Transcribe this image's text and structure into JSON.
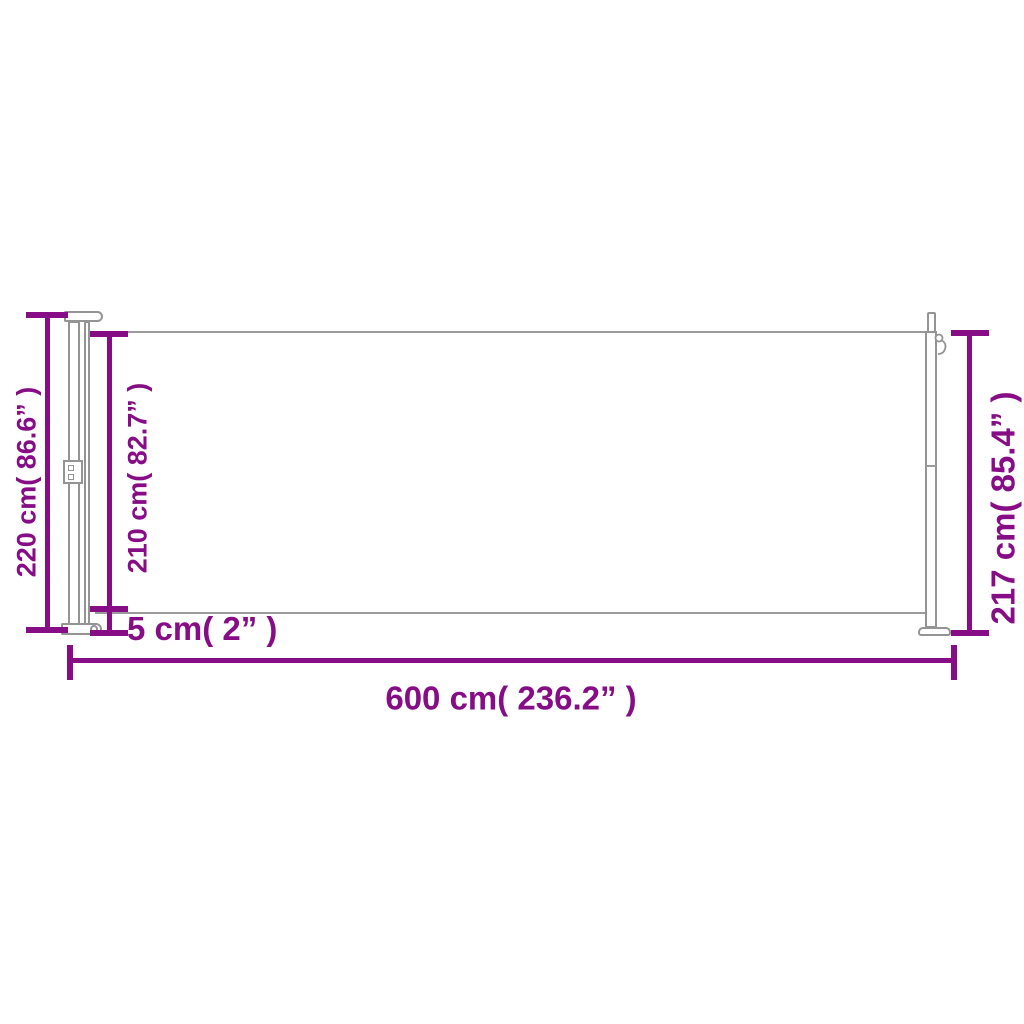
{
  "diagram": {
    "type": "product-dimension-diagram",
    "accent_color": "#860d86",
    "outline_color": "#949494",
    "background": "#ffffff",
    "dimensions": {
      "total_height": {
        "label": "220 cm( 86.6” )",
        "cm": 220,
        "inches": 86.6,
        "side": "left-outer"
      },
      "fabric_height": {
        "label": "210 cm( 82.7” )",
        "cm": 210,
        "inches": 82.7,
        "side": "left-inner"
      },
      "ground_clearance": {
        "label": "5 cm( 2” )",
        "cm": 5,
        "inches": 2,
        "side": "bottom-left"
      },
      "total_length": {
        "label": "600 cm( 236.2” )",
        "cm": 600,
        "inches": 236.2,
        "side": "bottom"
      },
      "pole_height": {
        "label": "217 cm( 85.4” )",
        "cm": 217,
        "inches": 85.4,
        "side": "right"
      }
    }
  }
}
